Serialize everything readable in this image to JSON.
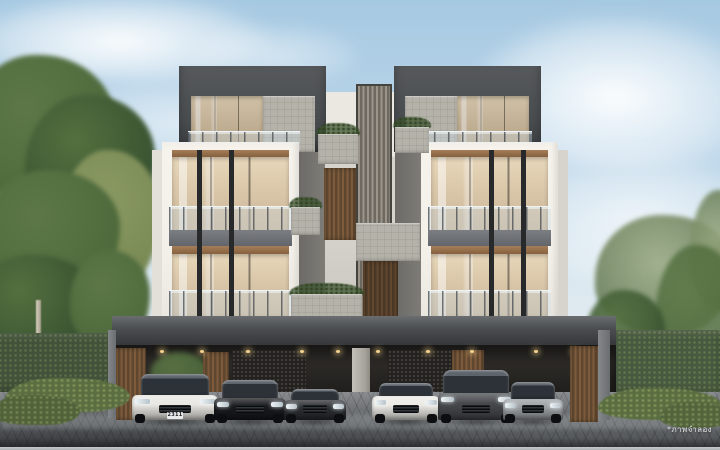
{
  "scene": {
    "type": "architectural rendering",
    "subject": "Modern 4-storey luxury townhomes with shared carport and six parked cars",
    "setting": "daytime, light blue sky with soft clouds, green hedges and trees on both sides, cobblestone driveway",
    "watermark_text": "*ภาพจำลอง"
  },
  "palette": {
    "sky_top": "#a6c9e2",
    "sky_horizon": "#eef2f3",
    "facade_white": "#f3f0e9",
    "facade_dark": "#4b4e51",
    "stone": "#b4b2a9",
    "wood": "#7d5b3c",
    "wood_deep": "#5f472f",
    "glass_warm": "#e8d7ba",
    "glass_warm_deep": "#c9b394",
    "mullion": "#27292b",
    "hedge": "#42523a",
    "tree": "#4e6a3c",
    "tree_light": "#7a8a55",
    "canopy": "#4a4d50",
    "interior": "#262421",
    "driveway": "#5c5f63"
  },
  "building": {
    "storeys": 4,
    "units": 2,
    "features": [
      "dark grey rooftop parapet boxes",
      "white frame facades",
      "floor-to-ceiling warm-lit glazing with dark mullions",
      "glass balcony railings",
      "central vertical wood louver screens",
      "stone planter boxes with greenery",
      "full-width dark carport canopy with downlights",
      "wood slat carport columns and gates"
    ]
  },
  "cars": [
    {
      "id": "car-1",
      "label": "white luxury sedan",
      "type": "sedan",
      "color": "#e9e7e2",
      "plate": "2311",
      "x": 132,
      "w": 86,
      "h": 48
    },
    {
      "id": "car-2",
      "label": "black sedan",
      "type": "sedan",
      "color": "#181a1d",
      "x": 214,
      "w": 72,
      "h": 42
    },
    {
      "id": "car-3",
      "label": "dark sports car",
      "type": "sports",
      "color": "#2b2e32",
      "x": 284,
      "w": 62,
      "h": 36
    },
    {
      "id": "car-4",
      "label": "white supercar",
      "type": "sports",
      "color": "#eceae5",
      "x": 372,
      "w": 68,
      "h": 42
    },
    {
      "id": "car-5",
      "label": "grey luxury suv",
      "type": "suv",
      "color": "#474a4d",
      "x": 438,
      "w": 76,
      "h": 52
    },
    {
      "id": "car-6",
      "label": "silver coupe",
      "type": "coupe",
      "color": "#9b9fa3",
      "x": 503,
      "w": 60,
      "h": 40
    }
  ]
}
